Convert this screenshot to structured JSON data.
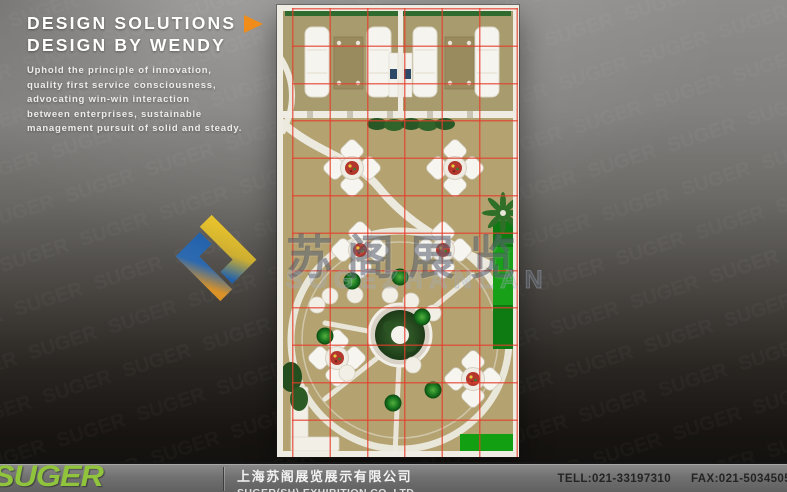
{
  "header": {
    "title_line1": "DESIGN SOLUTIONS",
    "title_line2": "DESIGN BY WENDY",
    "description_lines": [
      "Uphold the principle of innovation,",
      "quality first service consciousness,",
      "advocating win-win interaction",
      "between enterprises, sustainable",
      "management pursuit of solid and steady."
    ]
  },
  "watermark": {
    "brand_cn": "苏阁展览",
    "brand_en": "SUGEZHANLAN"
  },
  "footer": {
    "logo_text": "SUGER",
    "company_cn": "上海苏阁展览展示有限公司",
    "company_en": "SUGER(SH) EXHIBITION CO.,LTD",
    "tel": "TELL:021-33197310",
    "fax": "FAX:021-5034505"
  },
  "colors": {
    "accent_orange": "#ef8c1a",
    "logo_green": "#8fc43c",
    "grid_red": "#e43e2c",
    "floor_tan": "#b4a271",
    "carpet_green": "#18a018",
    "brandmark_blue": "#1f64b4",
    "brandmark_yellow": "#f0c929"
  }
}
